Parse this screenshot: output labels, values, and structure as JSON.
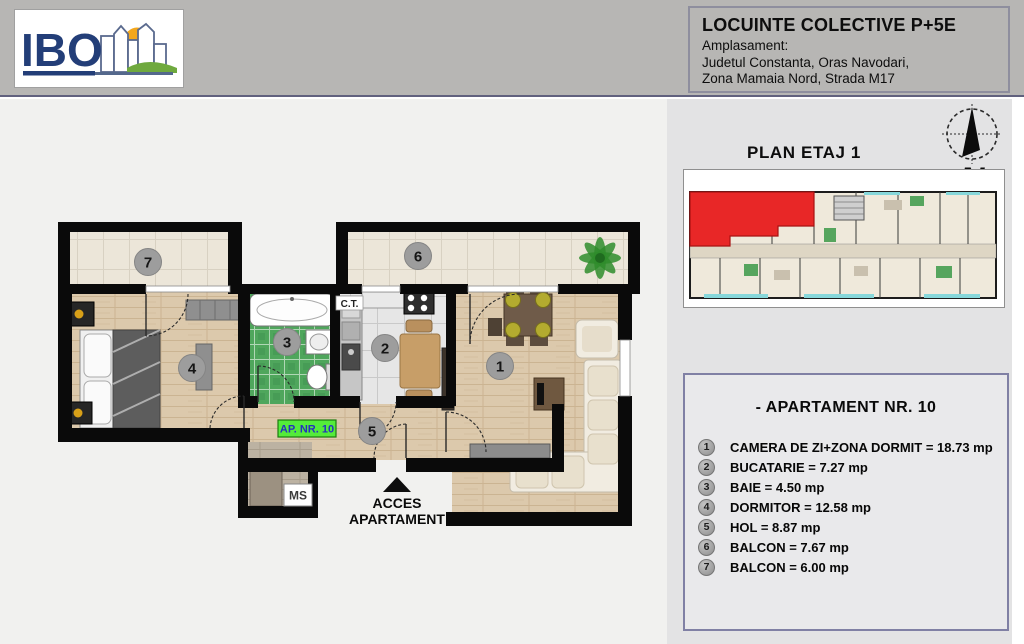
{
  "colors": {
    "header_bg": "#b7b6b4",
    "panel_bg": "#e3e3e4",
    "main_bg": "#f1f1ef",
    "highlight_red": "#e82727",
    "balcony_glass_teal": "#33c3cc",
    "apartment_tag_green": "#54ec3a",
    "apartment_tag_text": "#2531c0",
    "logo_navy": "#233e78",
    "logo_sun": "#f3a71d",
    "logo_green": "#6fa93e",
    "wall_black": "#0a0a0a"
  },
  "header": {
    "logo_text": "IBO",
    "title": "LOCUINTE COLECTIVE P+5E",
    "address_label": "Amplasament:",
    "address_line1": "Judetul Constanta, Oras Navodari,",
    "address_line2": "Zona Mamaia Nord,  Strada M17"
  },
  "right_panel": {
    "plan_title": "PLAN ETAJ 1",
    "compass_label": "N",
    "apartment_title": "- APARTAMENT NR. 10",
    "rooms": [
      {
        "num": "1",
        "label": "CAMERA DE ZI+ZONA DORMIT = 18.73 mp"
      },
      {
        "num": "2",
        "label": "BUCATARIE = 7.27 mp"
      },
      {
        "num": "3",
        "label": "BAIE = 4.50 mp"
      },
      {
        "num": "4",
        "label": "DORMITOR = 12.58 mp"
      },
      {
        "num": "5",
        "label": "HOL = 8.87 mp"
      },
      {
        "num": "6",
        "label": "BALCON = 7.67 mp"
      },
      {
        "num": "7",
        "label": "BALCON = 6.00 mp"
      }
    ]
  },
  "floor_plan": {
    "apartment_tag": "AP. NR. 10",
    "access_line1": "ACCES",
    "access_line2": "APARTAMENT",
    "ms_label": "MS",
    "ct_label": "C.T.",
    "numbers": {
      "living": "1",
      "kitchen": "2",
      "bath": "3",
      "bedroom": "4",
      "hall": "5",
      "balcony_living": "6",
      "balcony_bedroom": "7"
    }
  }
}
